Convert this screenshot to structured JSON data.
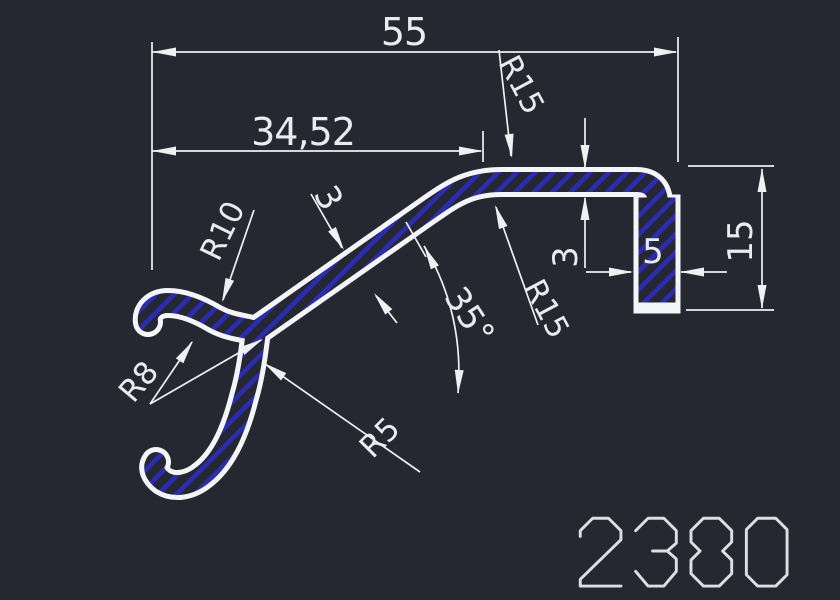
{
  "app": {
    "background_color": "#252831",
    "outline_color": "#f4f5f7",
    "dimension_line_color": "#eef0f2",
    "dimension_text_color": "#e9ebee",
    "hatch_color": "#2b2bb4",
    "drawing_number_color": "#dcdee2"
  },
  "drawing": {
    "number": "2380",
    "view": "profile-cross-section"
  },
  "dimensions": {
    "overall_width": "55",
    "partial_width": "34,52",
    "radius_top_outer": "R15",
    "radius_top_inner": "R15",
    "wall_thickness_diagonal": "3",
    "wall_thickness_top": "3",
    "leg_width": "5",
    "leg_height": "15",
    "slope_angle": "35°",
    "radius_finger_outer": "R10",
    "radius_claw_inner": "R8",
    "radius_junction": "R5"
  }
}
